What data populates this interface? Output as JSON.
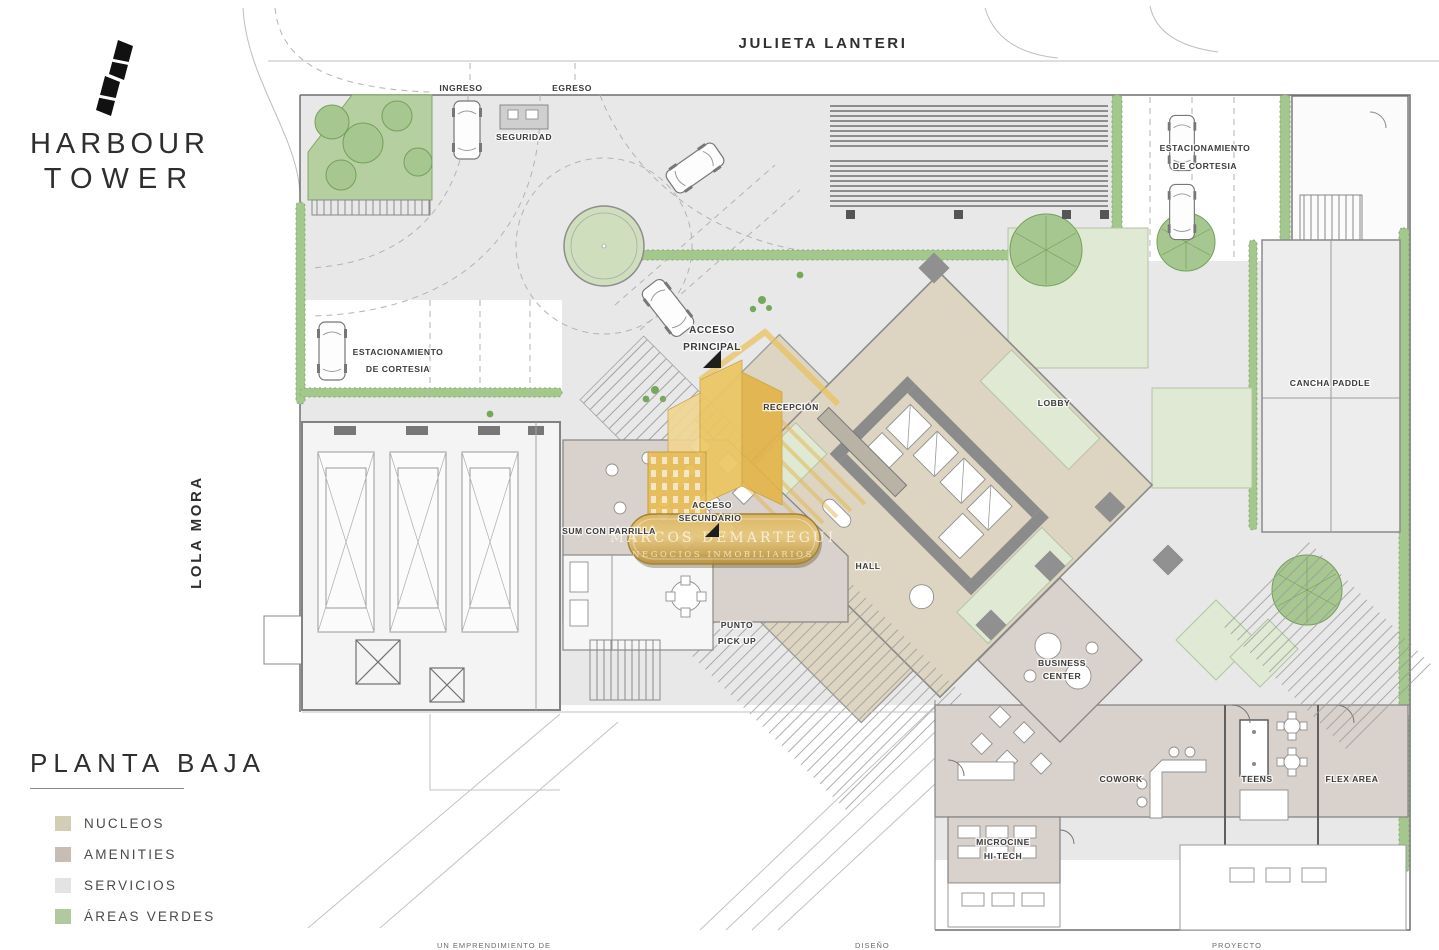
{
  "brand": {
    "line1": "HARBOUR",
    "line2": "TOWER"
  },
  "streets": {
    "top": "JULIETA LANTERI",
    "left": "LOLA MORA"
  },
  "plan_title": "PLANTA BAJA",
  "legend": {
    "items": [
      {
        "label": "NUCLEOS",
        "color": "#d4cdb6"
      },
      {
        "label": "AMENITIES",
        "color": "#c7bdb5"
      },
      {
        "label": "SERVICIOS",
        "color": "#e3e3e3"
      },
      {
        "label": "ÁREAS VERDES",
        "color": "#b2c9a0"
      }
    ]
  },
  "labels": {
    "ingreso": "INGRESO",
    "egreso": "EGRESO",
    "seguridad": "SEGURIDAD",
    "estacionamiento_top_l1": "ESTACIONAMIENTO",
    "estacionamiento_top_l2": "DE CORTESIA",
    "estacionamiento_left_l1": "ESTACIONAMIENTO",
    "estacionamiento_left_l2": "DE CORTESIA",
    "acceso_principal_l1": "ACCESO",
    "acceso_principal_l2": "PRINCIPAL",
    "recepcion": "RECEPCIÓN",
    "lobby": "LOBBY",
    "cancha_paddle": "CANCHA PADDLE",
    "acceso_secundario_l1": "ACCESO",
    "acceso_secundario_l2": "SECUNDARIO",
    "sum_con_parrilla": "SUM CON PARRILLA",
    "hall": "HALL",
    "punto_pickup_l1": "PUNTO",
    "punto_pickup_l2": "PICK UP",
    "business_center_l1": "BUSINESS",
    "business_center_l2": "CENTER",
    "cowork": "COWORK",
    "teens": "TEENS",
    "flex_area": "FLEX AREA",
    "microcine_l1": "MICROCINE",
    "microcine_l2": "HI-TECH"
  },
  "watermark": {
    "line1": "MARCOS DEMARTEGUI",
    "line2": "NEGOCIOS INMOBILIARIOS"
  },
  "footer": {
    "left": "UN EMPRENDIMIENTO DE",
    "center": "DISEÑO",
    "right": "PROYECTO"
  },
  "colors": {
    "gold": "#e0b44f",
    "ground": "#e8e8e8",
    "nucleo": "#ddd5c1",
    "amenity": "#d9d1cb",
    "green": "#a4c78d"
  }
}
